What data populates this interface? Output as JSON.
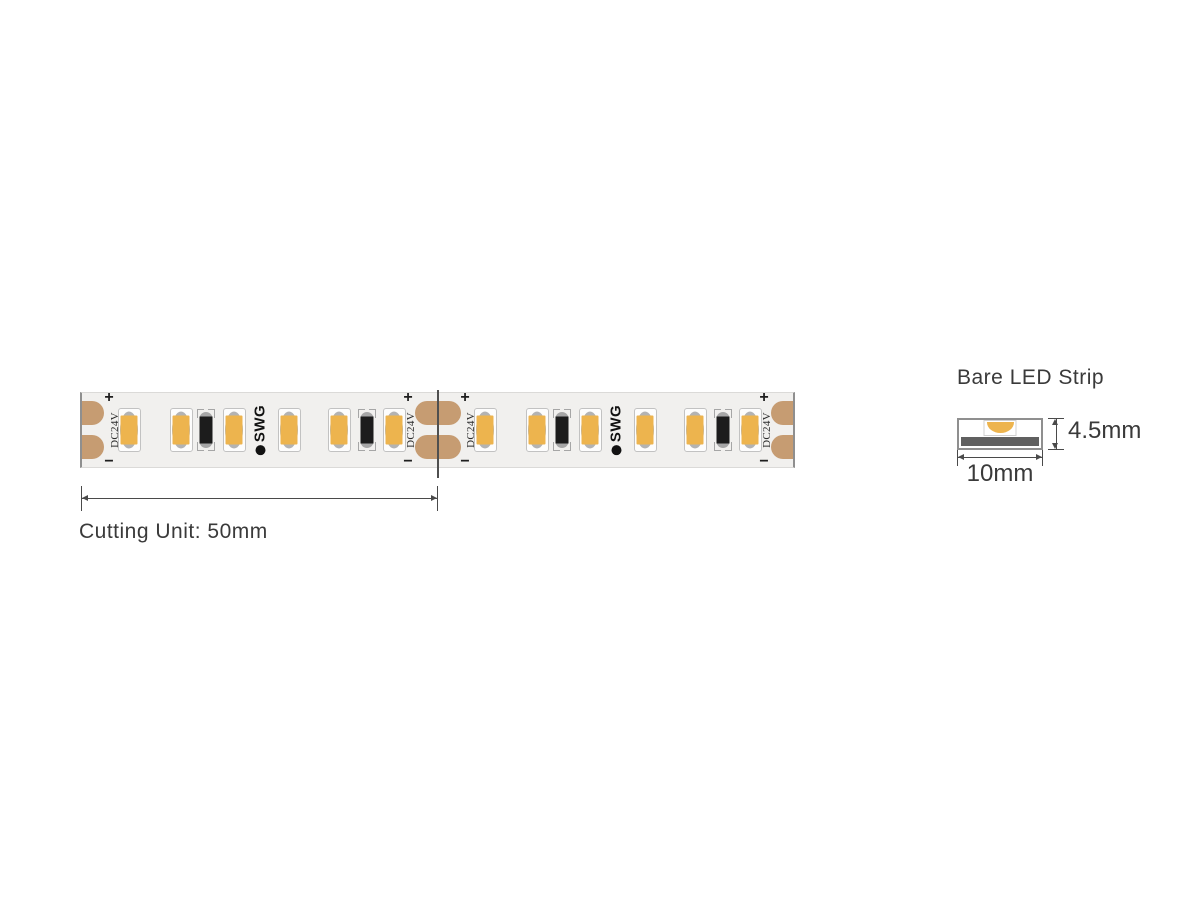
{
  "strip": {
    "voltage_label": "DC24V",
    "brand_label": "SWG",
    "polarity_plus": "+",
    "polarity_minus": "−",
    "unit_count": 2,
    "leds_per_unit": 6,
    "resistors_per_unit": 2,
    "colors": {
      "strip_body": "#F1F0EE",
      "strip_edge": "#8F8F8F",
      "copper_pad": "#C69C72",
      "led_yellow": "#EDB44E",
      "led_border": "#C2C2C2",
      "led_reflector": "#B3B3B3",
      "resistor_body": "#1C1C1C",
      "resistor_cap": "#A6A6A6",
      "cut_line": "#4F4F4F",
      "pcb_dark": "#606060",
      "dimension_line": "#4A4A4A"
    }
  },
  "cutting_dimension": {
    "label": "Cutting Unit: 50mm"
  },
  "cross_section": {
    "title": "Bare LED Strip",
    "height_label": "4.5mm",
    "width_label": "10mm"
  }
}
